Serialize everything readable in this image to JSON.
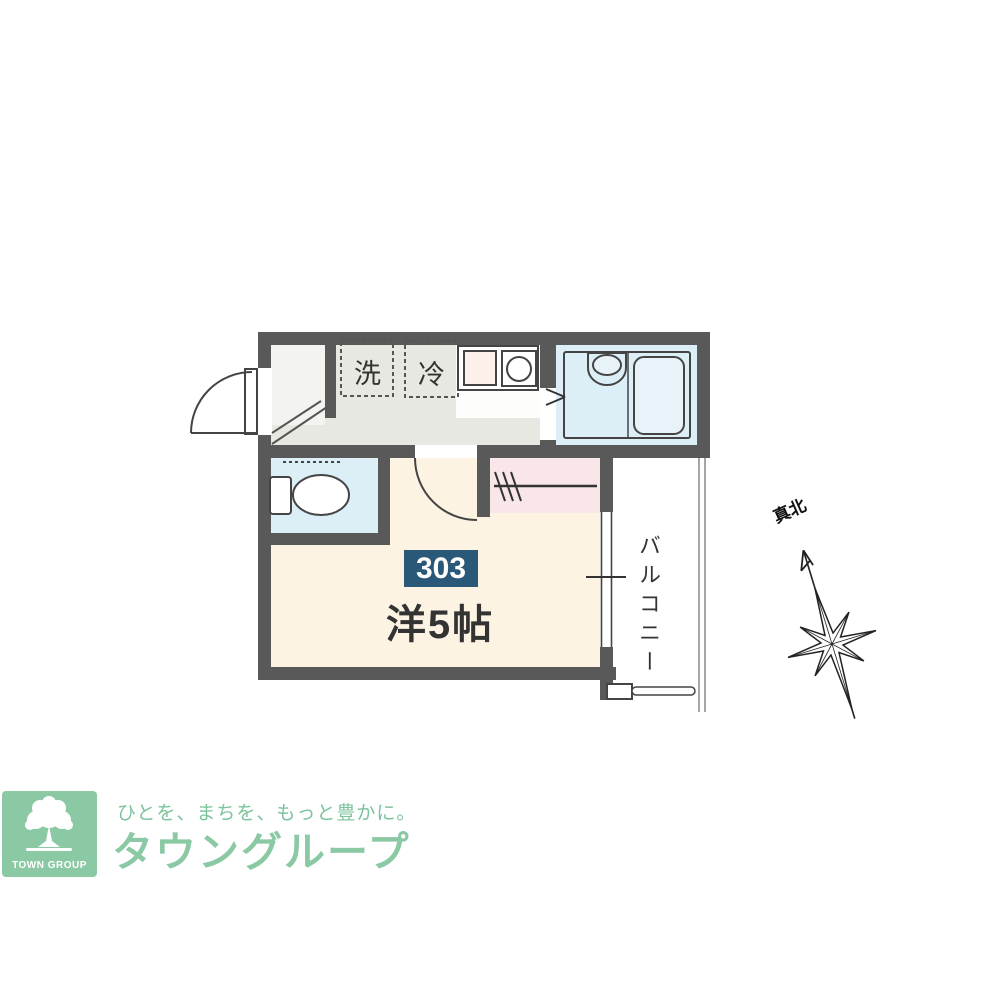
{
  "plan": {
    "unit_number": "303",
    "room_size_label": "洋5帖",
    "balcony_label": "バルコニー",
    "washer_label": "洗",
    "fridge_label": "冷",
    "true_north_label": "真北",
    "colors": {
      "wall": "#595959",
      "main_room_floor": "#fcf3e2",
      "wet_area_floor": "#dceef6",
      "closet_floor": "#f8e6e8",
      "kitchen_floor": "#e8e8e3",
      "unit_badge": "#2a5878"
    }
  },
  "footer": {
    "tagline": "ひとを、まちを、もっと豊かに。",
    "brand_name": "タウングループ",
    "logo_text": "TOWN GROUP",
    "brand_color": "#8bc9a4"
  }
}
